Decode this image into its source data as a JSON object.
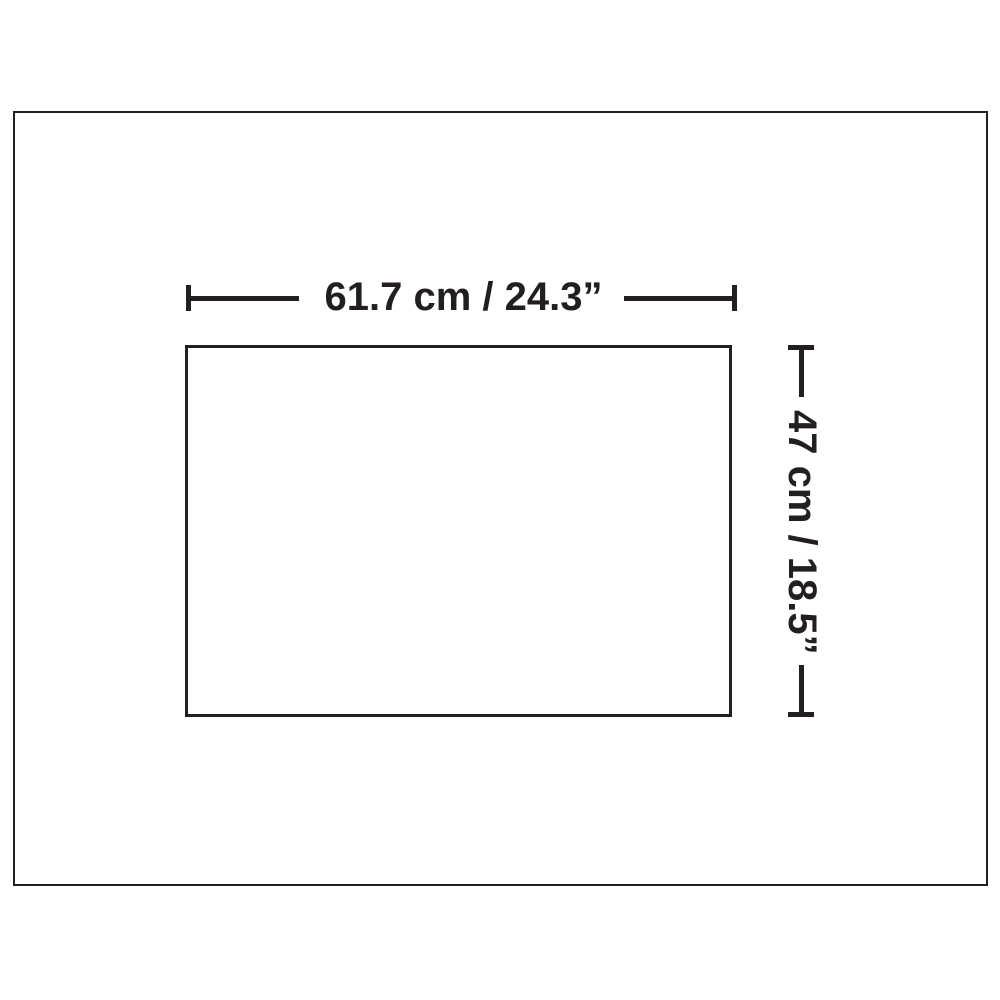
{
  "diagram": {
    "type": "product-dimension-diagram",
    "background_color": "#ffffff",
    "line_color": "#231f20",
    "width_dimension": {
      "label": "61.7 cm / 24.3”",
      "cm": 61.7,
      "inches": 24.3,
      "orientation": "horizontal"
    },
    "height_dimension": {
      "label": "47 cm / 18.5”",
      "cm": 47,
      "inches": 18.5,
      "orientation": "vertical"
    }
  }
}
